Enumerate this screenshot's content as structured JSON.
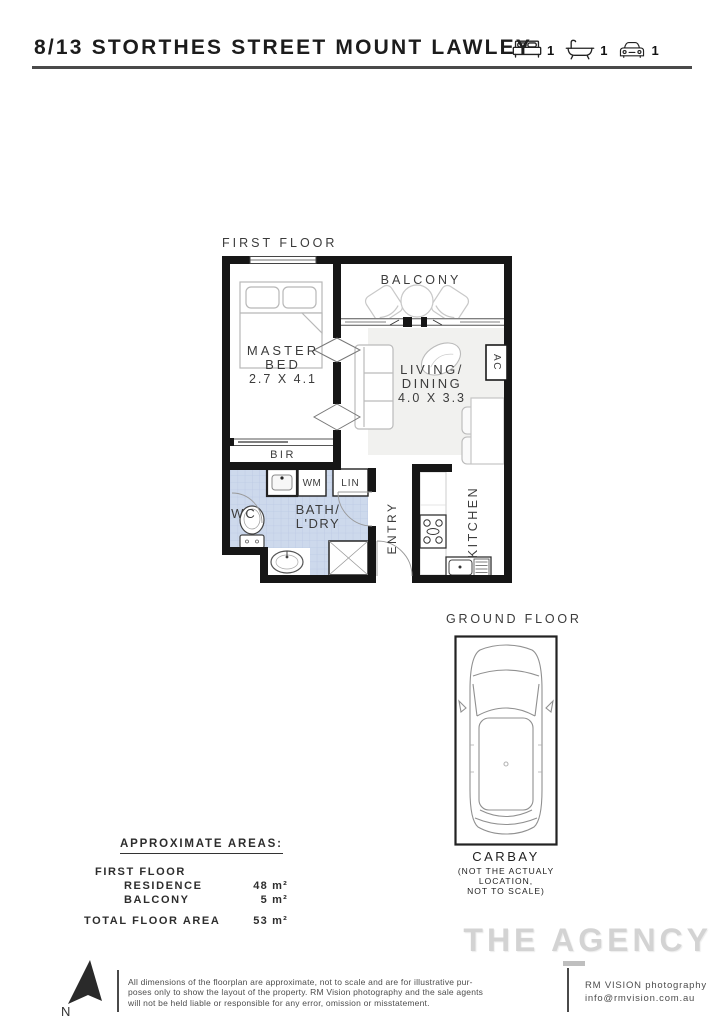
{
  "header": {
    "title": "8/13 STORTHES STREET MOUNT LAWLEY",
    "beds": "1",
    "baths": "1",
    "cars": "1"
  },
  "first_floor": {
    "label": "FIRST FLOOR",
    "rooms": {
      "balcony": "BALCONY",
      "master_bed_line1": "MASTER",
      "master_bed_line2": "BED",
      "master_bed_dims": "2.7 X 4.1",
      "living_line1": "LIVING/",
      "living_line2": "DINING",
      "living_dims": "4.0 X 3.3",
      "ac": "AC",
      "bir": "BIR",
      "wc": "WC",
      "bath_line1": "BATH/",
      "bath_line2": "L'DRY",
      "wm": "WM",
      "lin": "LIN",
      "entry": "ENTRY",
      "kitchen": "KITCHEN"
    }
  },
  "ground_floor": {
    "label": "GROUND FLOOR",
    "carbay": "CARBAY",
    "note_line1": "(NOT THE ACTUALY",
    "note_line2": "LOCATION,",
    "note_line3": "NOT TO SCALE)"
  },
  "areas": {
    "heading": "APPROXIMATE AREAS:",
    "rows": [
      {
        "label": "FIRST FLOOR",
        "value": ""
      },
      {
        "label": "RESIDENCE",
        "value": "48 m²"
      },
      {
        "label": "BALCONY",
        "value": "5 m²"
      },
      {
        "label": "TOTAL FLOOR AREA",
        "value": "53 m²"
      }
    ]
  },
  "branding": {
    "agency": "THE AGENCY"
  },
  "footer": {
    "north": "N",
    "disclaimer_line1": "All dimensions of the floorplan are approximate, not to scale and are for illustrative pur-",
    "disclaimer_line2": "poses only to show the layout of the property. RM Vision photography and the sale agents",
    "disclaimer_line3": "will not be held liable or responsible for any error, omission or misstatement.",
    "credit_line1": "RM VISION photography",
    "credit_line2": "info@rmvision.com.au"
  },
  "colors": {
    "wall": "#161616",
    "tile": "#cdd9ec",
    "tile_grid": "#bcc9e4",
    "rule": "#4a4a4a",
    "logo_gray": "#d3d3d3"
  }
}
